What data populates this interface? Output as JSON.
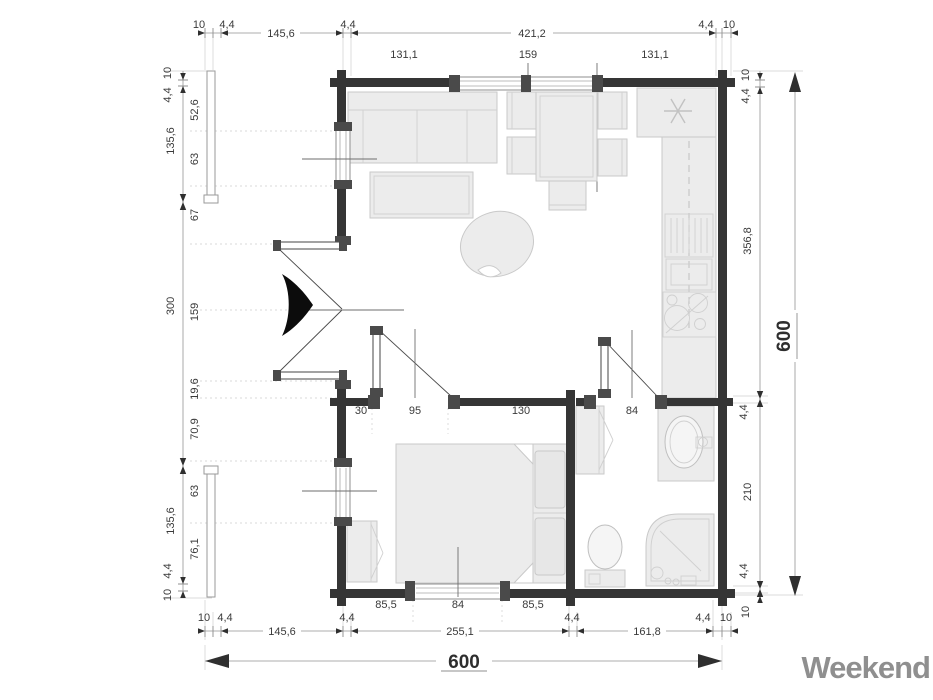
{
  "logo": {
    "text": "Weekend",
    "color": "#8f8f8f"
  },
  "colors": {
    "wall": "#353535",
    "furniture_fill": "#ececec",
    "furniture_stroke": "#c9c9c9",
    "dim_line": "#949494",
    "label": "#3a3a3a"
  },
  "dims": {
    "top_outer": [
      "10",
      "4,4",
      "145,6",
      "4,4",
      "421,2",
      "4,4",
      "10"
    ],
    "top_inner": [
      "131,1",
      "159",
      "131,1"
    ],
    "left_outer": [
      "10",
      "4,4",
      "135,6",
      "300",
      "135,6",
      "4,4",
      "10"
    ],
    "left_inner": [
      "52,6",
      "63",
      "67",
      "159",
      "19,6",
      "70,9",
      "63",
      "76,1"
    ],
    "right_inner": [
      "10",
      "4,4",
      "356,8",
      "4,4",
      "210",
      "4,4",
      "10"
    ],
    "right_total": "600",
    "mid": [
      "30",
      "95",
      "130",
      "15,2",
      "84",
      "62,6"
    ],
    "bottom_inner": [
      "85,5",
      "84",
      "85,5"
    ],
    "bottom_outer": [
      "10",
      "4,4",
      "145,6",
      "4,4",
      "255,1",
      "4,4",
      "161,8",
      "4,4",
      "10"
    ],
    "bottom_total": "600"
  }
}
